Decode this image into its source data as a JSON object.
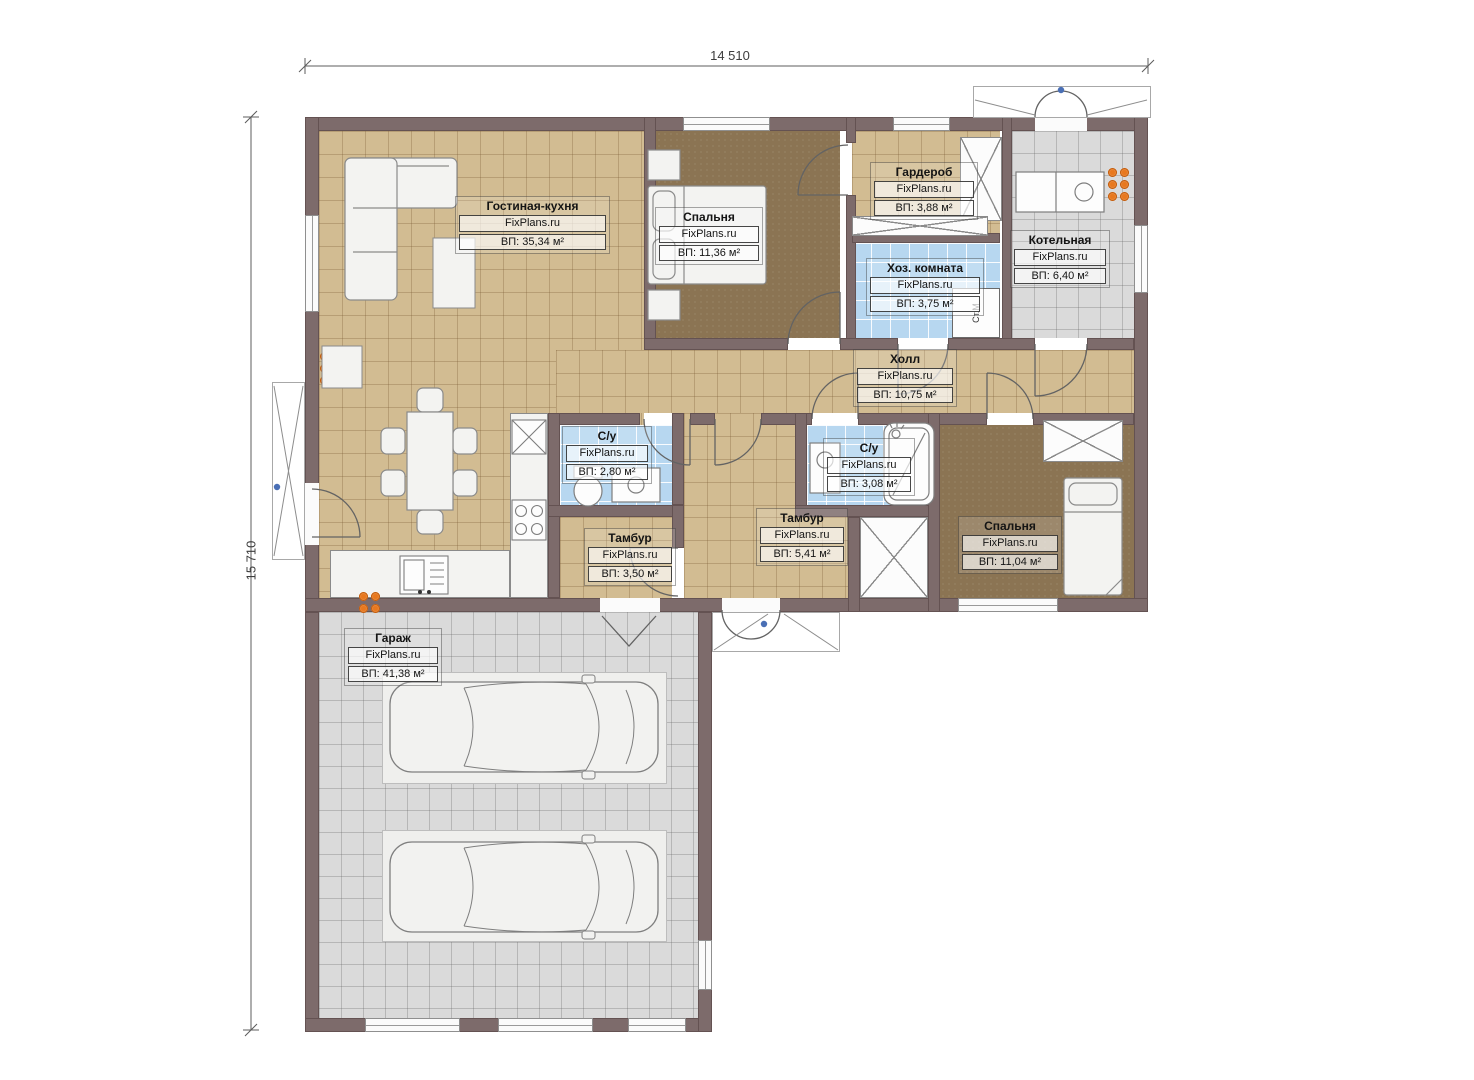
{
  "plan": {
    "source_watermark": "FixPlans.ru",
    "dimensions": {
      "width_mm": "14 510",
      "height_mm": "15 710"
    }
  },
  "rooms": [
    {
      "name": "Гостиная-кухня",
      "watermark": "FixPlans.ru",
      "area": "ВП: 35,34 м²"
    },
    {
      "name": "Спальня",
      "watermark": "FixPlans.ru",
      "area": "ВП: 11,36 м²"
    },
    {
      "name": "Гардероб",
      "watermark": "FixPlans.ru",
      "area": "ВП: 3,88 м²"
    },
    {
      "name": "Хоз. комната",
      "watermark": "FixPlans.ru",
      "area": "ВП: 3,75 м²"
    },
    {
      "name": "Котельная",
      "watermark": "FixPlans.ru",
      "area": "ВП: 6,40 м²"
    },
    {
      "name": "Холл",
      "watermark": "FixPlans.ru",
      "area": "ВП: 10,75 м²"
    },
    {
      "name": "С/у",
      "watermark": "FixPlans.ru",
      "area": "ВП: 2,80 м²"
    },
    {
      "name": "С/у",
      "watermark": "FixPlans.ru",
      "area": "ВП: 3,08 м²"
    },
    {
      "name": "Тамбур",
      "watermark": "FixPlans.ru",
      "area": "ВП: 3,50 м²"
    },
    {
      "name": "Тамбур",
      "watermark": "FixPlans.ru",
      "area": "ВП: 5,41 м²"
    },
    {
      "name": "Спальня",
      "watermark": "FixPlans.ru",
      "area": "ВП: 11,04 м²"
    },
    {
      "name": "Гараж",
      "watermark": "FixPlans.ru",
      "area": "ВП: 41,38 м²"
    }
  ],
  "annotations": {
    "washing_machine": "Ст.М"
  },
  "colors": {
    "wall": "#7d6b6b",
    "floor_tan": "#d2bc92",
    "floor_blue": "#b7d7f0",
    "floor_gray": "#dadada",
    "floor_carpet": "#8b7453",
    "radiator": "#e8781e",
    "marker_blue": "#4a6fb5"
  }
}
